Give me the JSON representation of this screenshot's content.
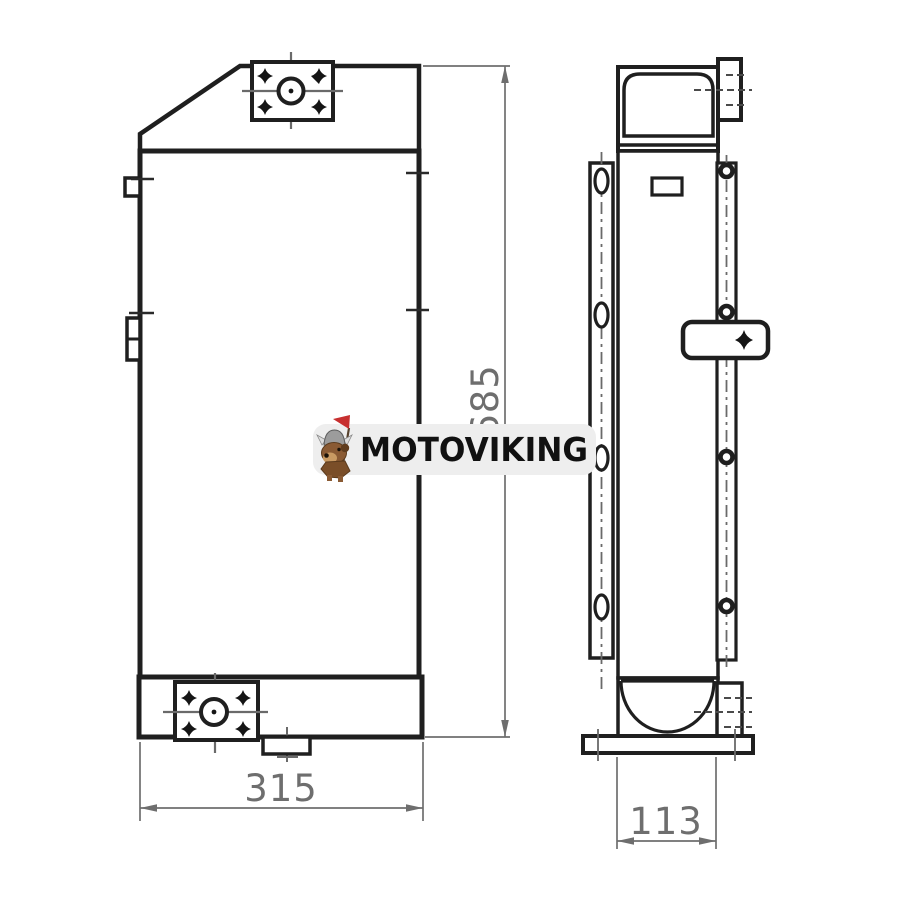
{
  "drawing": {
    "kind": "hydraulic-oil-cooler-technical-drawing",
    "views": {
      "front": "front-view",
      "side": "side-view"
    },
    "dimensions": {
      "width": "315",
      "height": "685",
      "depth": "113"
    },
    "colors": {
      "outline": "#1f1f1f",
      "dimension": "#6e6e6e",
      "centerline": "#6a6a6a",
      "background": "#ffffff"
    }
  },
  "watermark": {
    "brand": "MOTOVIKING",
    "pill_color": "#eeeeee",
    "text_color": "#111111",
    "flag_color": "#c72f2f",
    "mascot_icon": "viking-dog-with-flag-icon"
  }
}
